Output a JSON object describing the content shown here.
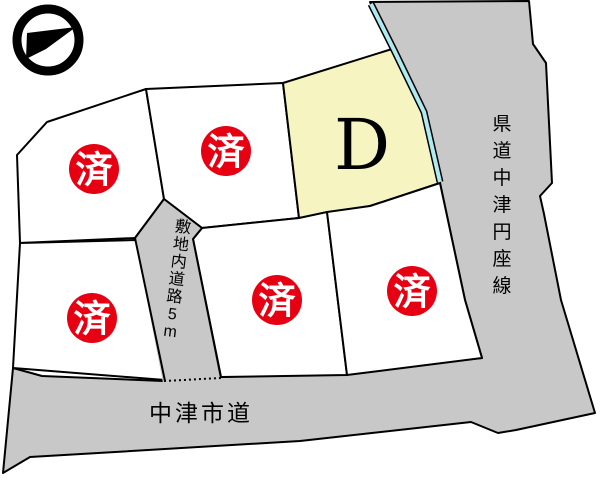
{
  "map": {
    "type": "residential-lot-plan",
    "compass": "north-arrow-pointing-upper-right"
  },
  "plots": [
    {
      "position": "top-left",
      "status": "sold",
      "label": "済"
    },
    {
      "position": "top-middle",
      "status": "sold",
      "label": "済"
    },
    {
      "position": "top-right",
      "status": "available",
      "label": "D"
    },
    {
      "position": "bottom-left",
      "status": "sold",
      "label": "済"
    },
    {
      "position": "bottom-middle",
      "status": "sold",
      "label": "済"
    },
    {
      "position": "bottom-right",
      "status": "sold",
      "label": "済"
    }
  ],
  "roads": {
    "prefectural_road": "県道中津円座線",
    "city_road": "中津市道",
    "internal_road": "敷地内道路5m"
  },
  "colors": {
    "sold_badge": "#e60012",
    "available_lot_fill": "#f6f5c1",
    "lot_fill": "#ffffff",
    "road_fill": "#c8c8c8",
    "boundary_line": "#000000",
    "water_line": "#aeeaf2"
  }
}
